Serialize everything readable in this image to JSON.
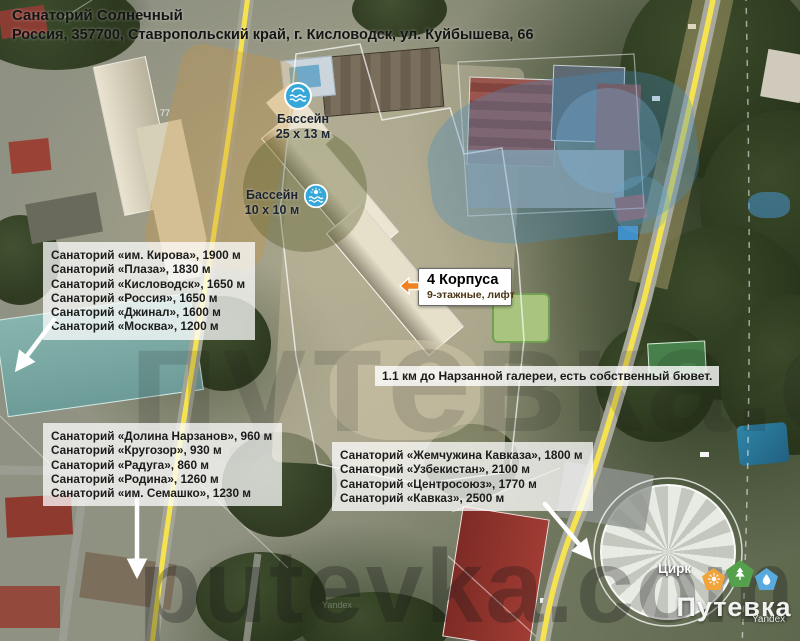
{
  "header": {
    "title": "Санаторий Солнечный",
    "address": "Россия, 357700, Ставропольский край, г. Кисловодск, ул. Куйбышева, 66"
  },
  "map_labels": {
    "pool_large": {
      "name": "Бассейн",
      "size": "25 х 13 м"
    },
    "pool_small": {
      "name": "Бассейн",
      "size": "10 х 10 м"
    },
    "house_number": "77",
    "circus": "Цирк"
  },
  "callout": {
    "title": "4 Корпуса",
    "subtitle": "9-этажные, лифт"
  },
  "note": "1.1 км до Нарзанной галереи, есть собственный бювет.",
  "sanatorium_lists": {
    "north": [
      "Санаторий «им. Кирова», 1900 м",
      "Санаторий «Плаза», 1830 м",
      "Санаторий «Кисловодск», 1650 м",
      "Санаторий «Россия», 1650 м",
      "Санаторий «Джинал», 1600 м",
      "Санаторий «Москва», 1200 м"
    ],
    "west": [
      "Санаторий «Долина Нарзанов», 960 м",
      "Санаторий «Кругозор», 930 м",
      "Санаторий «Радуга», 860 м",
      "Санаторий «Родина», 1260 м",
      "Санаторий «им. Семашко», 1230 м"
    ],
    "south": [
      "Санаторий «Жемчужина Кавказа», 1800 м",
      "Санаторий «Узбекистан», 2100 м",
      "Санаторий «Центросоюз», 1770 м",
      "Санаторий «Кавказ», 2500 м"
    ]
  },
  "watermarks": {
    "middle": "путевка.com",
    "bottom": "putevka.com",
    "attribution": "Yandex",
    "attribution_faint": "Yandex"
  },
  "logo": {
    "brand": "Путевка",
    "icon_colors": {
      "sun": "#f0a43c",
      "tree": "#54a04c",
      "drop": "#58aade"
    }
  },
  "colors": {
    "road_yellow": "#f4e24f",
    "accent_orange": "#f08222",
    "pool_icon_blue": "#35a7d8",
    "overlay_blue": "rgba(70,140,190,0.35)"
  }
}
